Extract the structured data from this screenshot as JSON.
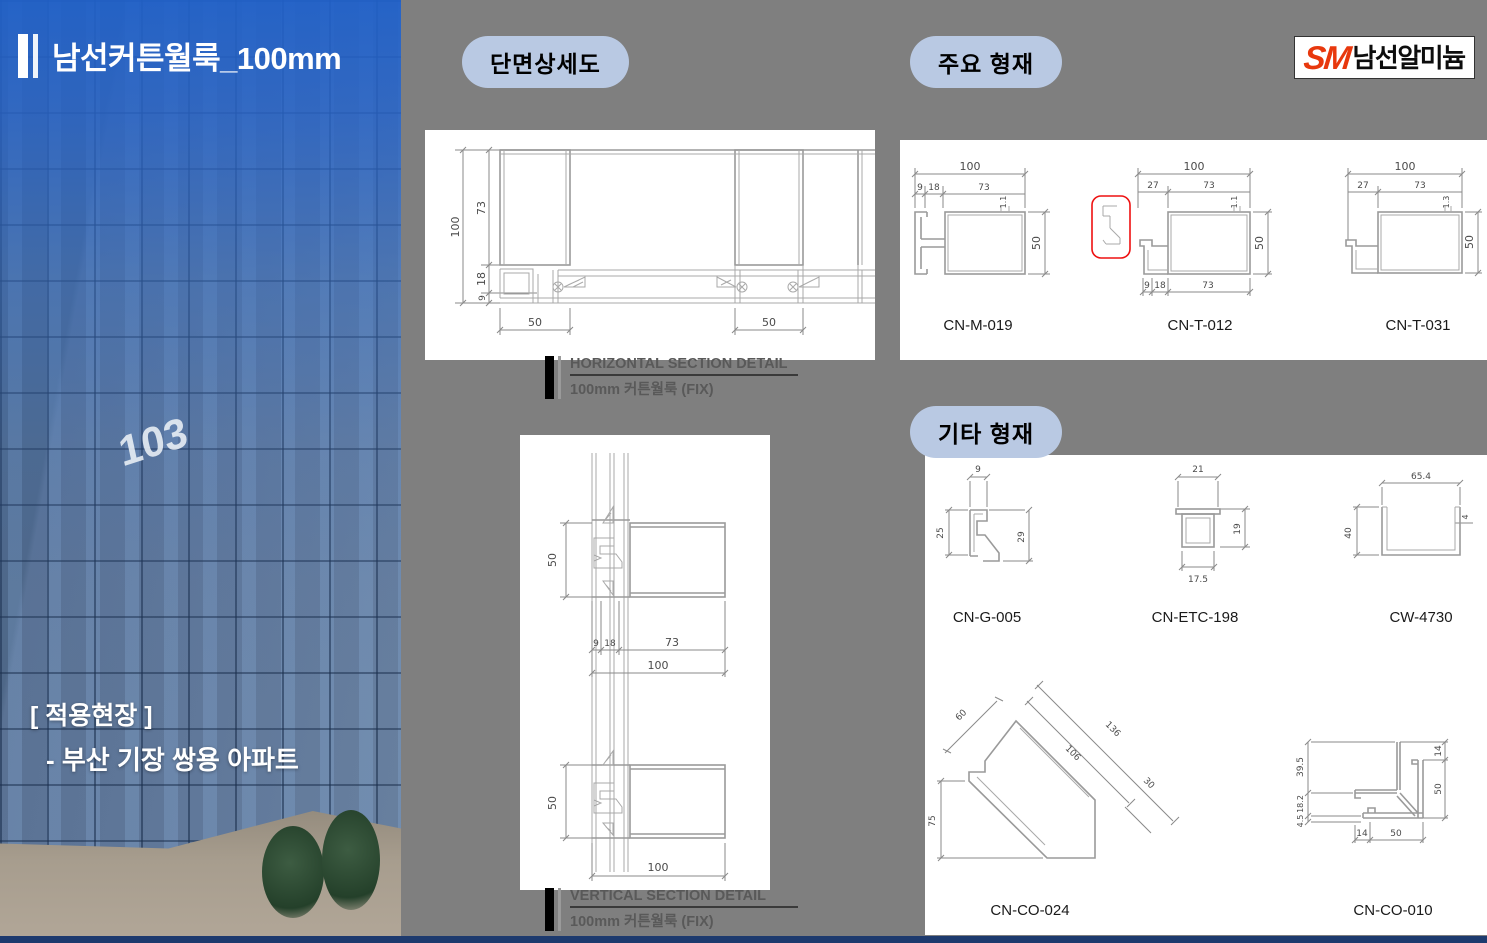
{
  "slide": {
    "title": "남선커튼월룩_100mm",
    "application_label": "[ 적용현장 ]",
    "application_site": "- 부산 기장 쌍용 아파트",
    "building_number": "103"
  },
  "logo": {
    "mark": "SM",
    "company": "남선알미늄"
  },
  "badges": {
    "section_detail": "단면상세도",
    "main_profiles": "주요 형재",
    "other_profiles": "기타 형재"
  },
  "hsec": {
    "caption_title": "HORIZONTAL SECTION DETAIL",
    "caption_sub": "100mm 커튼월룩 (FIX)",
    "dims": {
      "total": "100",
      "upper": "73",
      "mid": "18",
      "lower": "9",
      "left_mullion": "50",
      "right_mullion": "50"
    }
  },
  "vsec": {
    "caption_title": "VERTICAL SECTION DETAIL",
    "caption_sub": "100mm 커튼월룩 (FIX)",
    "dims": {
      "top_height": "50",
      "w1": "9",
      "w2": "18",
      "w3": "73",
      "w_total": "100",
      "bottom_height": "50",
      "w_bottom": "100"
    }
  },
  "main_profiles": {
    "items": [
      {
        "name": "CN-M-019",
        "total": "100",
        "s1": "9",
        "s2": "18",
        "s3": "73",
        "thk": "1.1",
        "height": "50"
      },
      {
        "name": "CN-T-012",
        "total": "100",
        "t1": "27",
        "t2": "73",
        "thk": "1.1",
        "height": "50",
        "b1": "9",
        "b2": "18",
        "b3": "73"
      },
      {
        "name": "CN-T-031",
        "total": "100",
        "t1": "27",
        "t2": "73",
        "thk": "1.3",
        "height": "50"
      }
    ]
  },
  "other_profiles": {
    "items": [
      {
        "name": "CN-G-005",
        "d1": "9",
        "d2": "25",
        "d3": "29"
      },
      {
        "name": "CN-ETC-198",
        "d1": "21",
        "d2": "19",
        "d3": "17.5"
      },
      {
        "name": "CW-4730",
        "d1": "65.4",
        "d2": "40",
        "d3": "4"
      },
      {
        "name": "CN-CO-024",
        "d1": "60",
        "d2": "106",
        "d3": "136",
        "d4": "30",
        "d5": "75"
      },
      {
        "name": "CN-CO-010",
        "d1": "39.5",
        "d2": "18.2",
        "d3": "4.5",
        "d4": "14",
        "d5": "50",
        "d6": "14",
        "d7": "50"
      }
    ]
  },
  "colors": {
    "background": "#7f7f7f",
    "badge_blue": "#b9c9e3",
    "footer_navy": "#1d3a6e",
    "logo_red": "#e8380d",
    "highlight_red": "#ee1111"
  }
}
